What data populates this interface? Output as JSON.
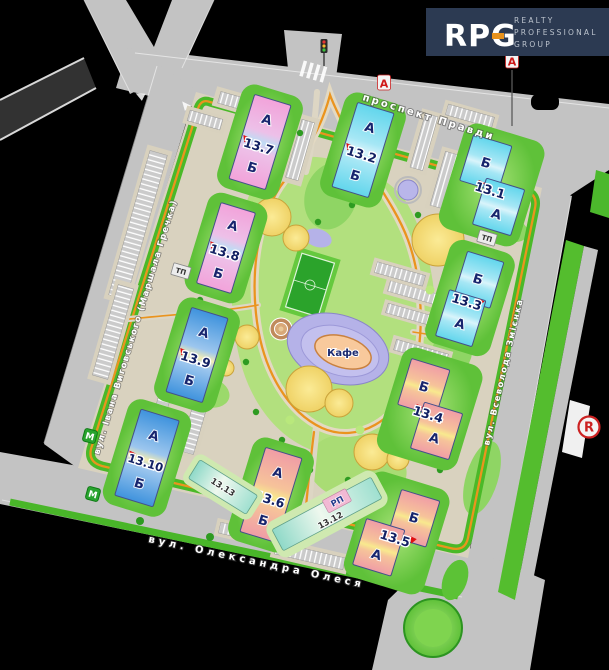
{
  "logo": {
    "monogram": "RPG",
    "words": [
      "REALTY",
      "PROFESSIONAL",
      "GROUP"
    ]
  },
  "streets": {
    "top": "проспект Правди",
    "left": "вул. Івана Виговського (Маршала Гречка)",
    "right": "вул. Всеволода Змієнка",
    "bottom": "вул. Олександра Олеся"
  },
  "buildings": [
    {
      "num": "13.7",
      "top": "А",
      "bottom": "Б",
      "palette": "pink"
    },
    {
      "num": "13.2",
      "top": "А",
      "bottom": "Б",
      "palette": "cyan"
    },
    {
      "num": "13.1",
      "top": "Б",
      "bottom": "А",
      "palette": "cyan"
    },
    {
      "num": "13.8",
      "top": "А",
      "bottom": "Б",
      "palette": "pink"
    },
    {
      "num": "13.3",
      "top": "Б",
      "bottom": "А",
      "palette": "cyan"
    },
    {
      "num": "13.9",
      "top": "А",
      "bottom": "Б",
      "palette": "blue"
    },
    {
      "num": "13.4",
      "top": "Б",
      "bottom": "А",
      "palette": "rose"
    },
    {
      "num": "13.10",
      "top": "А",
      "bottom": "Б",
      "palette": "blue"
    },
    {
      "num": "13.6",
      "top": "А",
      "bottom": "Б",
      "palette": "rose"
    },
    {
      "num": "13.5",
      "top": "Б",
      "bottom": "А",
      "palette": "rose"
    }
  ],
  "annexes": {
    "b1312": {
      "num": "13.12",
      "tag": "РП"
    },
    "b1313": {
      "num": "13.13"
    }
  },
  "poi": {
    "cafe": "Кафе"
  },
  "markers": {
    "transport_stop": "А",
    "metro": "М",
    "substation": "ТП",
    "registered": "R"
  },
  "colors": {
    "accent_orange": "#ea941e",
    "road_gray": "#c3c3c3",
    "ground": "#d9d2bf",
    "green": "#4ab928",
    "building_pink": "#f2a3da",
    "building_cyan": "#62d6ec",
    "building_blue": "#3f93dd",
    "building_rose": "#f09da6",
    "label_navy": "#1b2a70",
    "logo_bg": "#2c3a52",
    "marker_red": "#d01818"
  }
}
